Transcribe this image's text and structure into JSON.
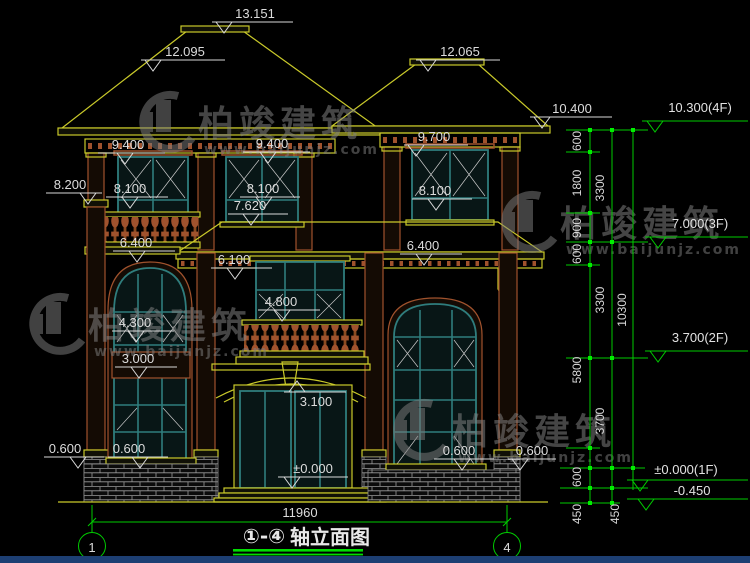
{
  "drawing": {
    "title_prefix": "①-④",
    "title_text": "轴立面图",
    "overall_width": "11960",
    "axis_start": "1",
    "axis_end": "4"
  },
  "marks": {
    "m13151": "13.151",
    "m12095": "12.095",
    "m12065": "12.065",
    "m10400": "10.400",
    "m9400a": "9.400",
    "m9400b": "9.400",
    "m9700": "9.700",
    "m8200": "8.200",
    "m8100a": "8.100",
    "m8100b": "8.100",
    "m8100c": "8.100",
    "m7620": "7.620",
    "m6400a": "6.400",
    "m6400b": "6.400",
    "m6100": "6.100",
    "m4800": "4.800",
    "m4300": "4.300",
    "m3100": "3.100",
    "m3000": "3.000",
    "m0000": "±0.000",
    "m0600a": "0.600",
    "m0600b": "0.600",
    "m0600c": "0.600",
    "m0600d": "0.600"
  },
  "right_dims": {
    "seg600a": "600",
    "seg1800": "1800",
    "seg900": "900",
    "seg600b": "600",
    "seg5800": "5800",
    "seg600c": "600",
    "seg450a": "450",
    "seg3300a": "3300",
    "seg3300b": "3300",
    "seg3700": "3700",
    "seg450b": "450",
    "seg10300": "10300"
  },
  "right_levels": {
    "l4f": "10.300(4F)",
    "l3f": "7.000(3F)",
    "l2f": "3.700(2F)",
    "l1f": "±0.000(1F)",
    "lneg": "-0.450"
  },
  "watermark": {
    "brand": "柏竣建筑",
    "url": "www.baijunjz.com"
  },
  "colors": {
    "cad_yellow": "#c9c92a",
    "cad_green": "#00cc00",
    "cad_tan": "#a0522d",
    "cad_teal": "#2f7d7d",
    "dim_text": "#d9d9d9",
    "watermark_gray": "#808080",
    "footer_blue": "#1d3f73"
  }
}
